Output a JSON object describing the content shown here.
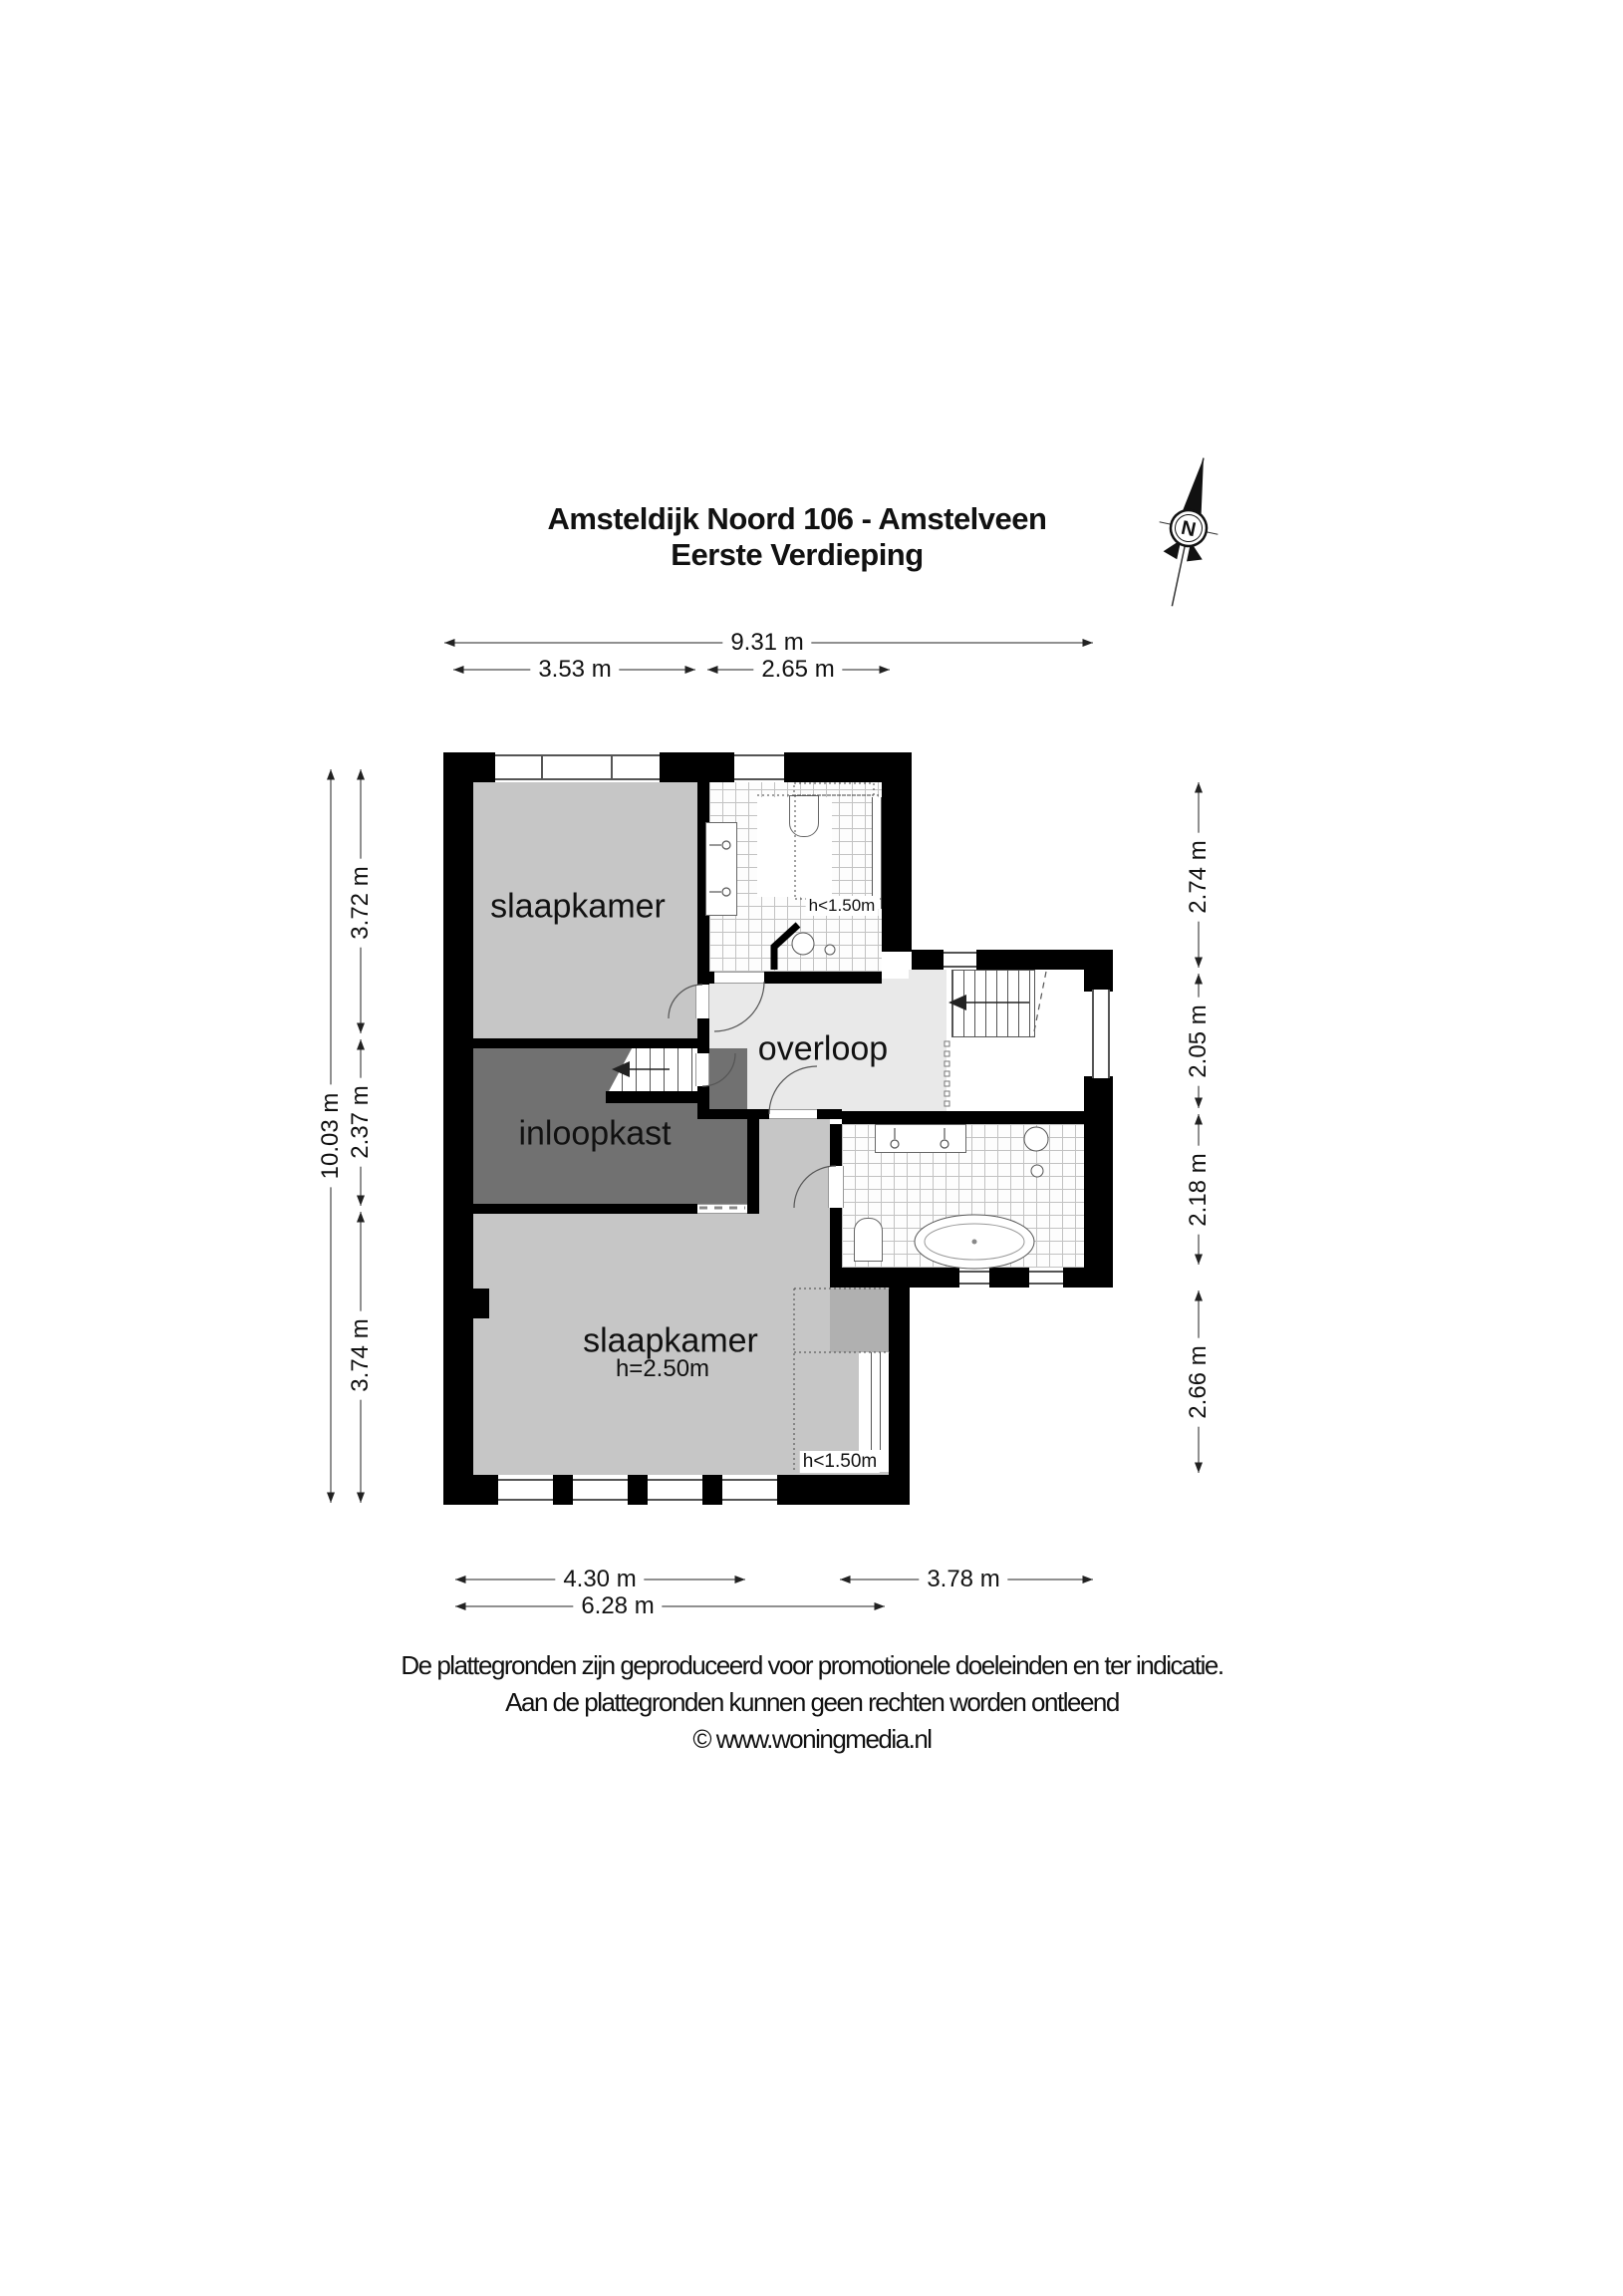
{
  "title": {
    "line1": "Amsteldijk Noord 106 - Amstelveen",
    "line2": "Eerste Verdieping"
  },
  "compass": {
    "label": "N"
  },
  "rooms": {
    "bedroom_top": "slaapkamer",
    "landing": "overloop",
    "closet": "inloopkast",
    "bedroom_bottom": "slaapkamer",
    "bedroom_bottom_height": "h=2.50m",
    "low_headroom_top": "h<1.50m",
    "low_headroom_bottom": "h<1.50m"
  },
  "dimensions": {
    "top_total": "9.31 m",
    "top_left": "3.53 m",
    "top_right": "2.65 m",
    "left_total": "10.03 m",
    "left_top": "3.72 m",
    "left_middle": "2.37 m",
    "left_bottom": "3.74 m",
    "right_top": "2.74 m",
    "right_upper_middle": "2.05 m",
    "right_lower_middle": "2.18 m",
    "right_bottom": "2.66 m",
    "bottom_left": "4.30 m",
    "bottom_right": "3.78 m",
    "bottom_total": "6.28 m"
  },
  "footer": {
    "line1": "De plattegronden zijn geproduceerd voor promotionele doeleinden en ter indicatie.",
    "line2": "Aan de plattegronden kunnen geen rechten worden ontleend",
    "line3": "© www.woningmedia.nl"
  },
  "colors": {
    "wall": "#000000",
    "bedroom_fill": "#c6c6c6",
    "closet_fill": "#717171",
    "landing_fill": "#e9e9e9",
    "low_zone_fill": "#b0b0b0"
  }
}
